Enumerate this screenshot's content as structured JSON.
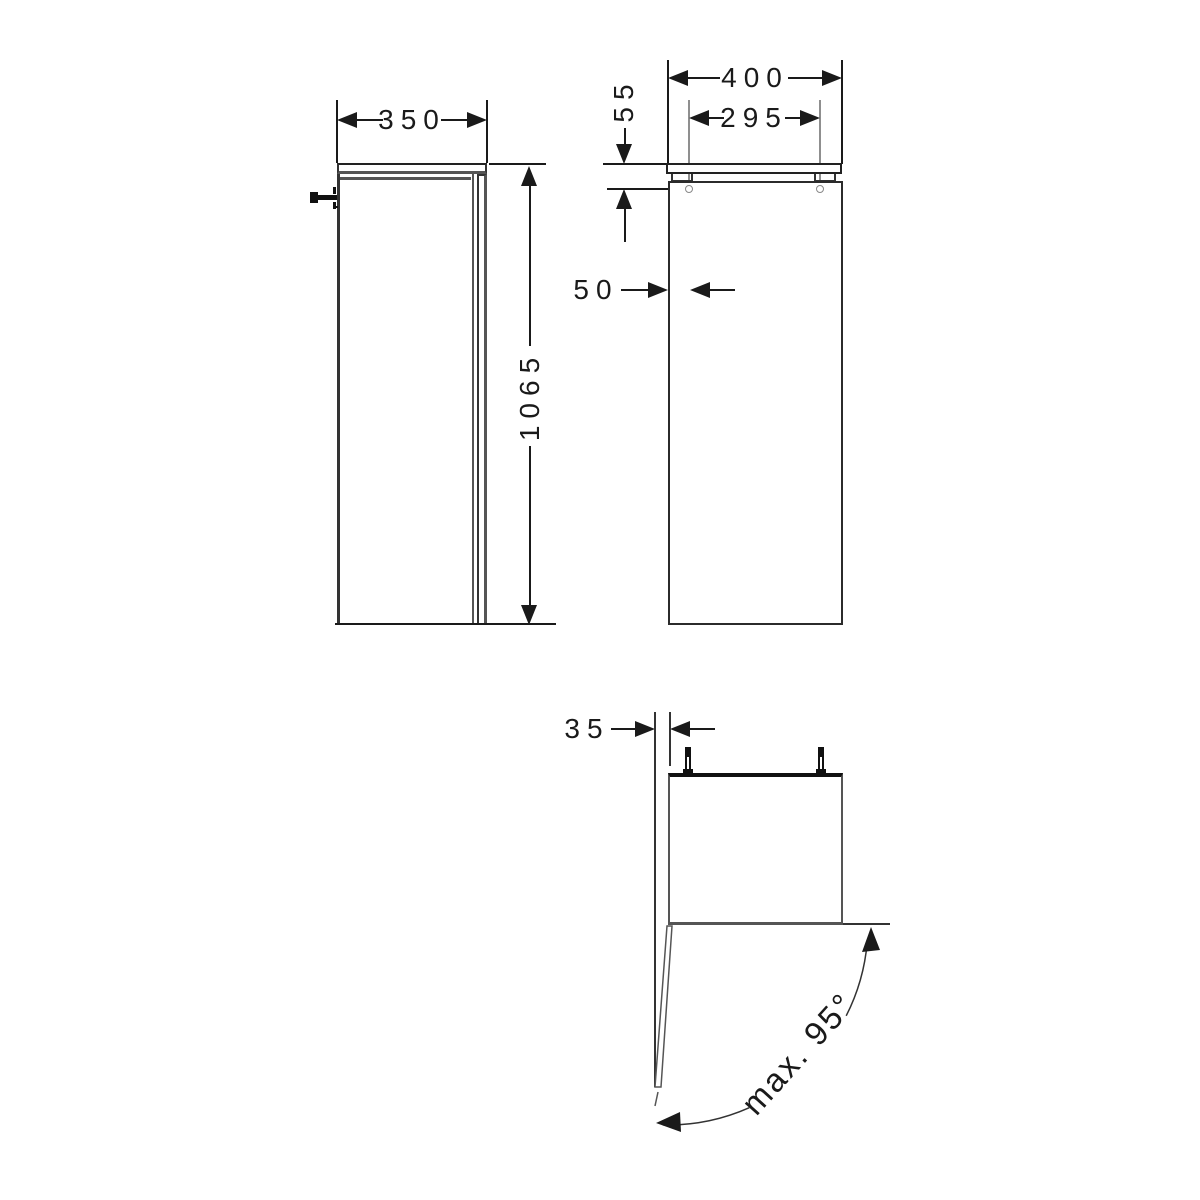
{
  "drawing": {
    "dims": {
      "side_width": "350",
      "side_height": "1065",
      "front_width": "400",
      "hole_spacing": "295",
      "top_to_hole": "55",
      "edge_to_hole": "50",
      "wall_offset": "35",
      "door_angle": "max. 95°"
    },
    "colors": {
      "line_dark": "#1a1a1a",
      "line_medium": "#555555",
      "line_light": "#8f8f8f",
      "background": "#ffffff"
    }
  }
}
